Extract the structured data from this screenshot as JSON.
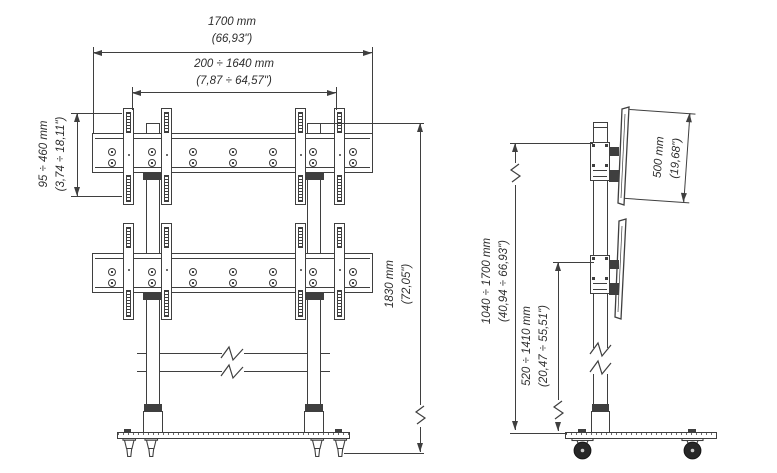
{
  "dimensions": {
    "total_width": {
      "metric": "1700 mm",
      "imperial": "(66,93\")"
    },
    "bracket_span_range": {
      "metric": "200 ÷ 1640 mm",
      "imperial": "(7,87 ÷ 64,57\")"
    },
    "bracket_vertical_range": {
      "metric": "95 ÷ 460 mm",
      "imperial": "(3,74 ÷ 18,11\")"
    },
    "total_height": {
      "metric": "1830 mm",
      "imperial": "(72,05\")"
    },
    "screen_mount_height": {
      "metric": "500 mm",
      "imperial": "(19,68\")"
    },
    "upper_screen_height_range": {
      "metric": "1040 ÷ 1700 mm",
      "imperial": "(40,94 ÷ 66,93\")"
    },
    "lower_screen_height_range": {
      "metric": "520 ÷ 1410 mm",
      "imperial": "(20,47 ÷ 55,51\")"
    }
  },
  "colors": {
    "line": "#3f3f3f",
    "text": "#2e2e2e",
    "background": "#ffffff"
  }
}
